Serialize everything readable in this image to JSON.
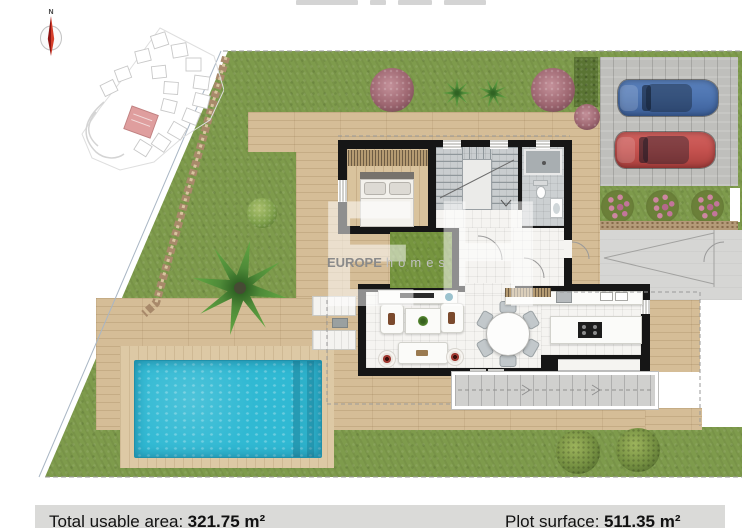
{
  "watermark": {
    "initials": "EH",
    "brand": "EUROPE",
    "brand_suffix": "homes"
  },
  "compass": {
    "north_label": "N"
  },
  "footer": {
    "total_label": "Total usable area:",
    "total_value": "321.75 m²",
    "plot_label": "Plot surface:",
    "plot_value": "511.35 m²"
  },
  "colors": {
    "lawn": "#7e9b4c",
    "deck_wood": "#d5bd97",
    "pool_water": "#30b9d3",
    "driveway": "#bfbfbc",
    "house_wall": "#161616",
    "inset_highlighted_unit": "#df9e9e",
    "car_blue": "#4d74b0",
    "car_red": "#c5524f",
    "footer_bar": "#dadad8"
  }
}
